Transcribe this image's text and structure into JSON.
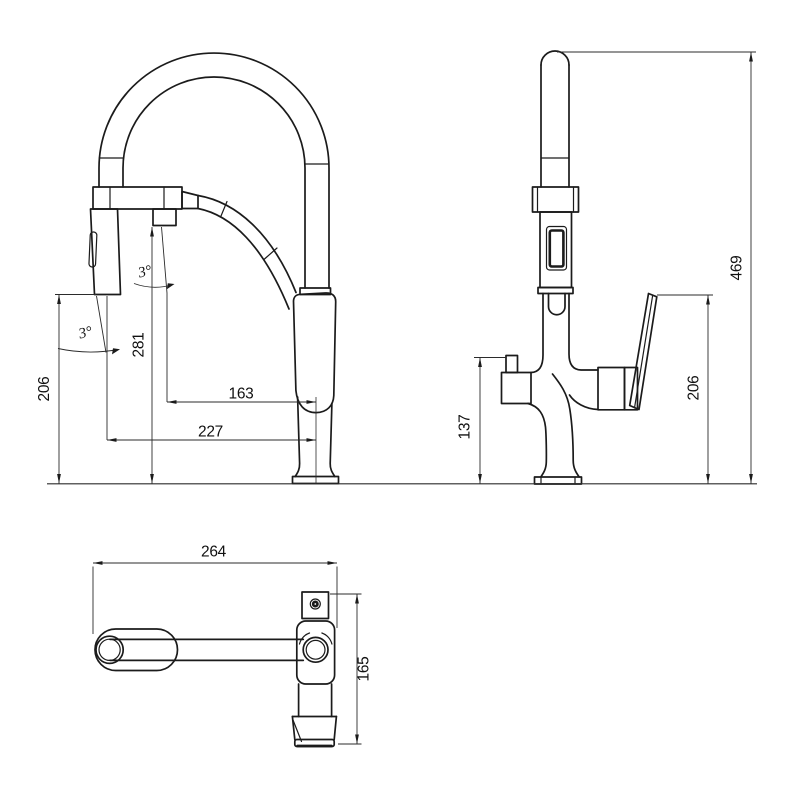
{
  "drawing": {
    "type": "faucet-dimension-drawing",
    "background_color": "#ffffff",
    "line_color": "#1b1b1b",
    "dim_line_color": "#2b2b2b",
    "text_color": "#111111"
  },
  "views": {
    "front": {
      "label": "front-view-with-pullout-spray",
      "dimensions": {
        "spray_head_height": "206",
        "hose_tube_height": "281",
        "spout_center_reach": "163",
        "spray_head_reach": "227",
        "hose_tube_angle": "3°",
        "spray_head_angle": "3°"
      }
    },
    "side": {
      "label": "side-view",
      "dimensions": {
        "overall_height": "469",
        "handle_height": "206",
        "side_spout_height": "137"
      }
    },
    "top": {
      "label": "top-view",
      "dimensions": {
        "overall_length": "264",
        "overall_depth": "165"
      }
    }
  }
}
